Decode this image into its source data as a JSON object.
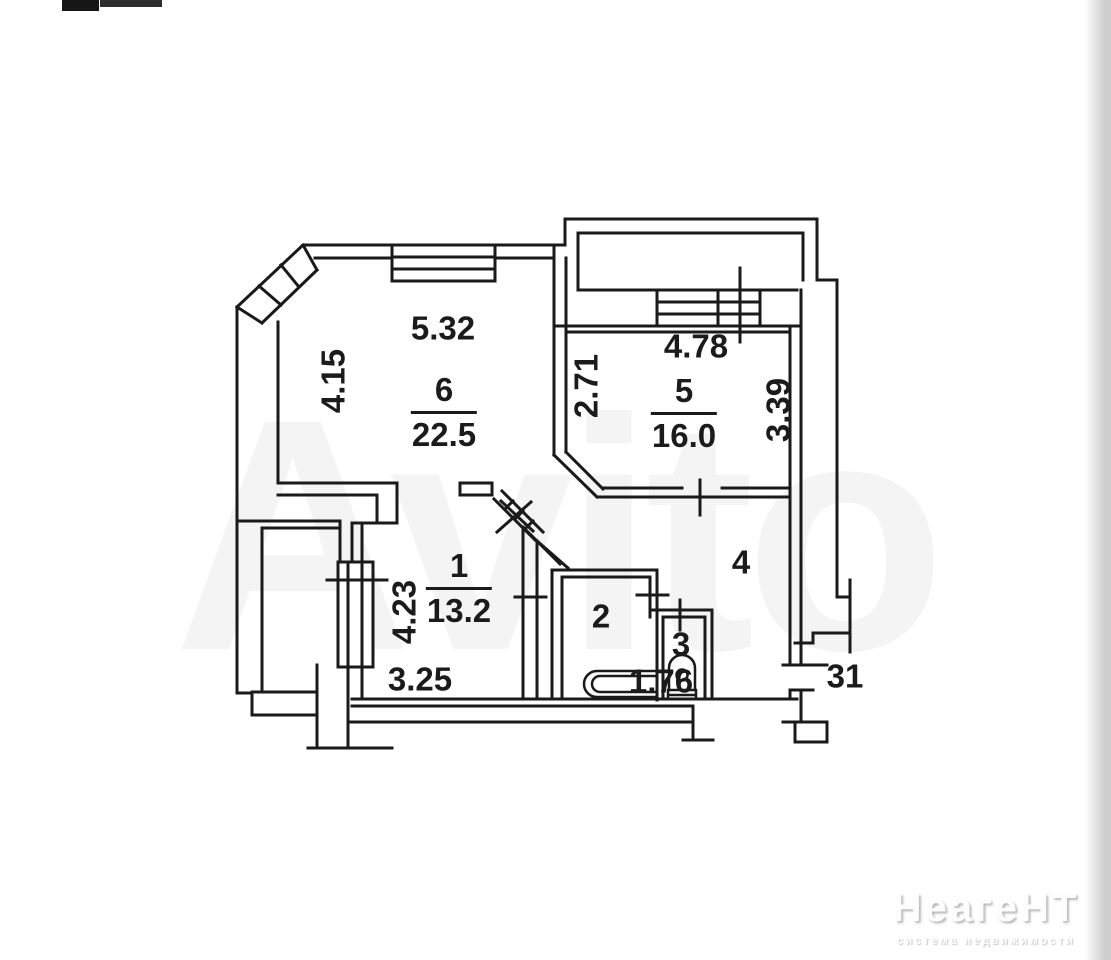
{
  "watermark": {
    "text": "Avito"
  },
  "brand": {
    "name": "НеагеНТ",
    "tagline": "система недвижимости"
  },
  "plan": {
    "colors": {
      "wall": "#1a1a1a",
      "paper": "#ffffff"
    },
    "rooms": [
      {
        "key": "living",
        "number": "6",
        "area": "22.5"
      },
      {
        "key": "bedroom",
        "number": "5",
        "area": "16.0"
      },
      {
        "key": "room1",
        "number": "1",
        "area": "13.2"
      },
      {
        "key": "bathroom",
        "number": "2"
      },
      {
        "key": "wc",
        "number": "3"
      },
      {
        "key": "hallway",
        "number": "4"
      }
    ],
    "dims": {
      "room6_width": "5.32",
      "room6_height": "4.15",
      "room5_width": "4.78",
      "room5_left": "2.71",
      "room5_right": "3.39",
      "room1_height": "4.23",
      "room1_width": "3.25",
      "entry_hall": "1.76",
      "stair_landing": "31"
    }
  }
}
